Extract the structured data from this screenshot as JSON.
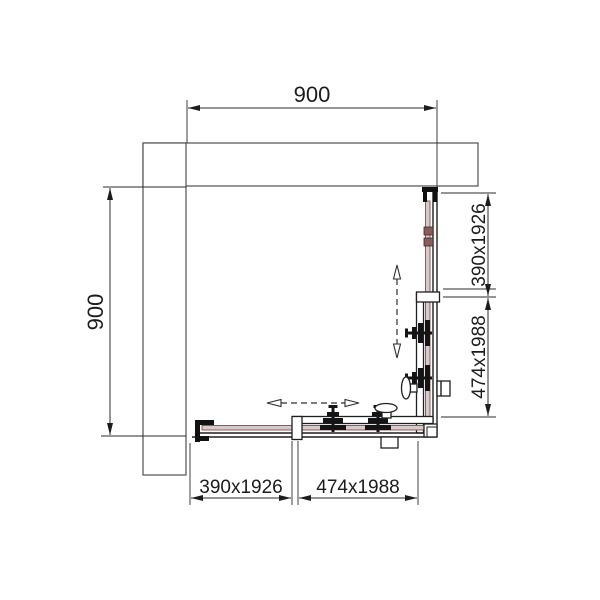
{
  "drawing": {
    "description": "Technical top-view CAD drawing of a square corner-entry shower enclosure with two fixed glass panels and two sliding doors",
    "dimensions": {
      "top_width": "900",
      "left_depth": "900",
      "right_fixed_panel": "390x1926",
      "right_door_panel": "474x1988",
      "bottom_fixed_panel": "390x1926",
      "bottom_door_panel": "474x1988"
    },
    "colors": {
      "background": "#ffffff",
      "line": "#2b2b2b",
      "wall_line": "#4f4f4f",
      "frame_line": "#1f1f1f",
      "glass_stroke": "#8a5c5c",
      "glass_fill": "#dcc8c8",
      "hardware": "#141414"
    }
  }
}
